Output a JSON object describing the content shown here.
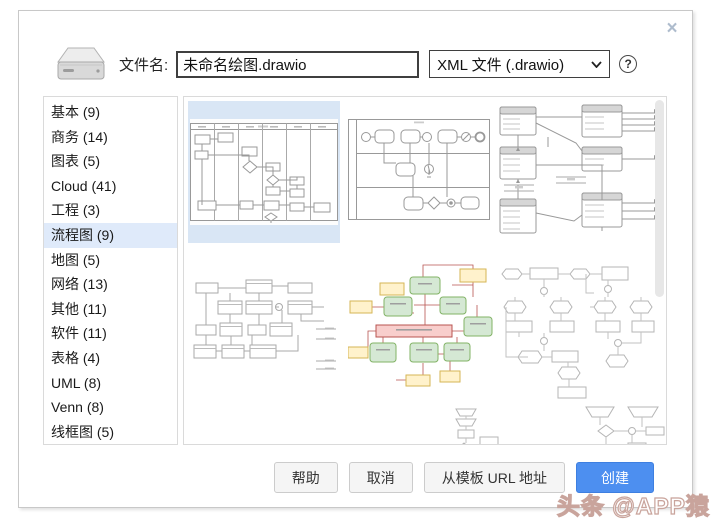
{
  "dialog": {
    "close_icon": "×",
    "file_label": "文件名:",
    "filename_value": "未命名绘图.drawio",
    "filetype_value": "XML 文件 (.drawio)",
    "help_icon": "?"
  },
  "sidebar": {
    "items": [
      {
        "label": "基本 (9)"
      },
      {
        "label": "商务 (14)"
      },
      {
        "label": "图表 (5)"
      },
      {
        "label": "Cloud (41)"
      },
      {
        "label": "工程 (3)"
      },
      {
        "label": "流程图 (9)",
        "selected": true
      },
      {
        "label": "地图 (5)"
      },
      {
        "label": "网络 (13)"
      },
      {
        "label": "其他 (11)"
      },
      {
        "label": "软件 (11)"
      },
      {
        "label": "表格 (4)"
      },
      {
        "label": "UML (8)"
      },
      {
        "label": "Venn (8)"
      },
      {
        "label": "线框图 (5)"
      }
    ]
  },
  "footer": {
    "help_label": "帮助",
    "cancel_label": "取消",
    "from_url_label": "从模板 URL 地址",
    "create_label": "创建"
  },
  "watermark": "头条 @APP猿",
  "colors": {
    "accent_blue": "#4d8ff0",
    "selected_sidebar_bg": "#dfeafa",
    "selected_thumb_bg": "#d9e6f5",
    "template_green_fill": "#d5e8d4",
    "template_green_stroke": "#82b366",
    "template_yellow_fill": "#fff2cc",
    "template_yellow_stroke": "#d6b656",
    "template_pink_fill": "#f8cecc",
    "template_pink_stroke": "#b85450"
  }
}
